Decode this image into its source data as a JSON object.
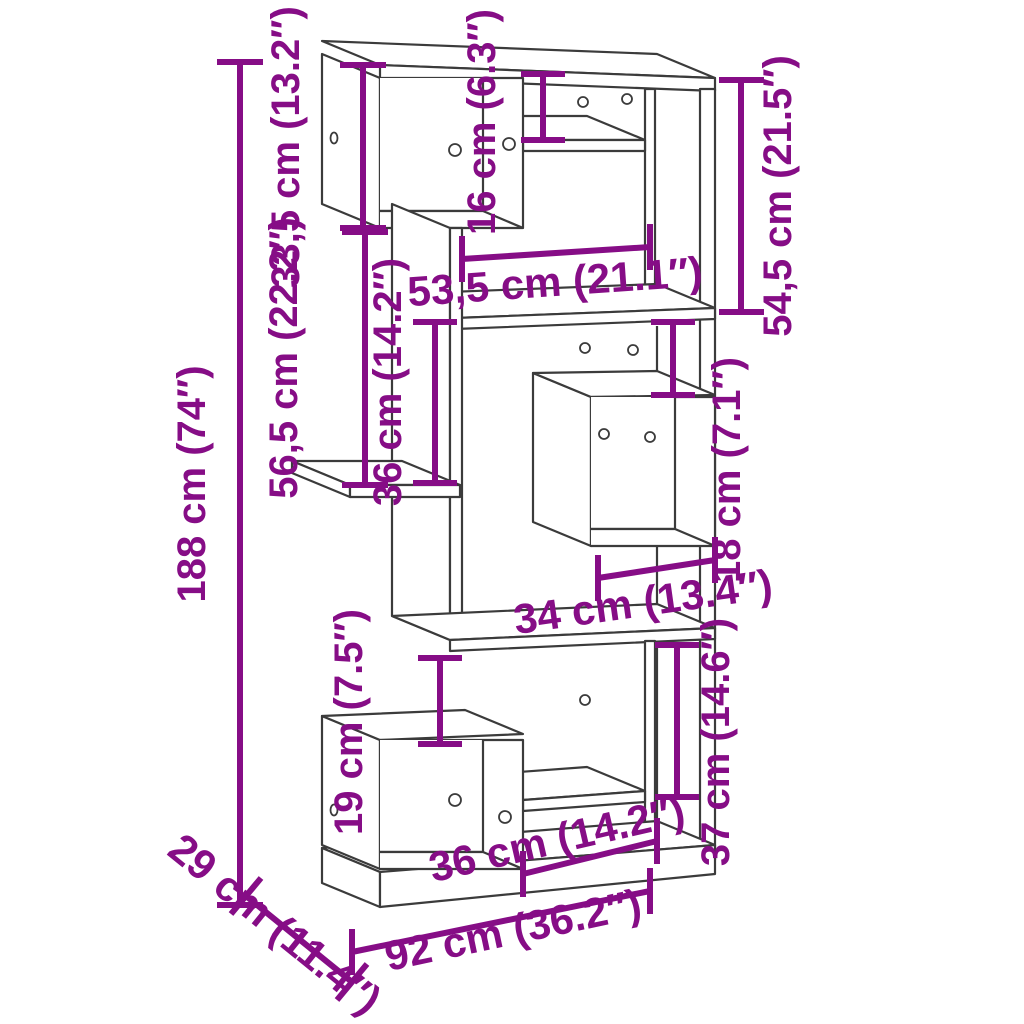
{
  "diagram": {
    "labels": {
      "total_height": "188 cm (74″)",
      "top_box_height": "33,5 cm (13.2″)",
      "top_shelf_height": "16 cm (6.3″)",
      "upper_right_height": "54,5 cm (21.5″)",
      "upper_opening_width": "53,5 cm (21.1″)",
      "mid_left_height": "56,5 cm (22.2″)",
      "mid_opening_height": "36 cm (14.2″)",
      "gap_above_cube": "18 cm (7.1″)",
      "cube_width": "34 cm (13.4″)",
      "gap_above_bottom_box": "19 cm (7.5″)",
      "lower_right_height": "37 cm (14.6″)",
      "bottom_opening_width": "36 cm (14.2″)",
      "total_depth": "29 cm (11.4″)",
      "total_width": "92 cm (36.2″)"
    },
    "colors": {
      "dimension": "#860D86",
      "line_art": "#3B3B3B",
      "background": "#FFFFFF"
    }
  }
}
